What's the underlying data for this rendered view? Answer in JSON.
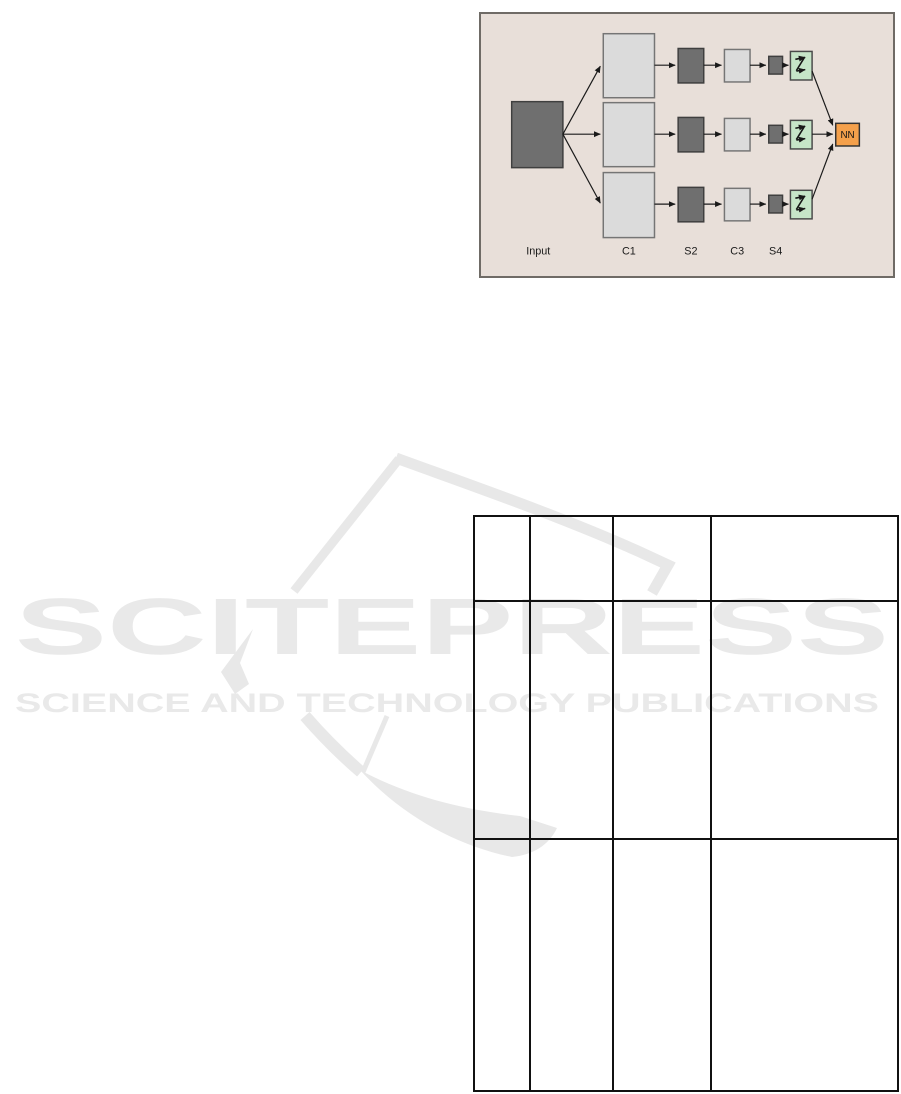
{
  "page": {
    "width": 901,
    "height": 1094,
    "background": "#ffffff"
  },
  "watermark": {
    "title": "SCITEPRESS",
    "subtitle": "SCIENCE AND TECHNOLOGY PUBLICATIONS",
    "color": "#e9e9e9"
  },
  "figure": {
    "background": "#e8dfd9",
    "border_color": "#6f6b66",
    "branches": 3,
    "labels": {
      "input": "Input",
      "c1": "C1",
      "s2": "S2",
      "c3": "C3",
      "s4": "S4",
      "nn": "NN"
    },
    "colors": {
      "input_box": "#6f6f6f",
      "conv_box": "#dbdbdb",
      "subsample_box": "#6f6f6f",
      "scan_box": "#c6e5c8",
      "nn_box": "#f4a04b",
      "arrow": "#1a1a1a"
    }
  },
  "table": {
    "border_color": "#111111",
    "rows": [
      [
        "",
        "",
        "",
        ""
      ],
      [
        "",
        "",
        "",
        ""
      ],
      [
        "",
        "",
        "",
        ""
      ]
    ]
  }
}
